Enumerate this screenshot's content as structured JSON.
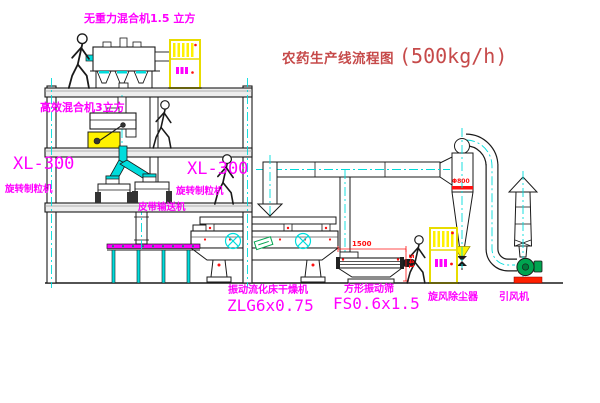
{
  "title": {
    "name": "农药生产线流程图",
    "capacity": "(500kg/h)"
  },
  "equipment_labels": {
    "gravity_mixer": "无重力混合机1.5 立方",
    "high_mixer": "高效混合机3立方",
    "granulator_left_model": "XL-300",
    "granulator_left_name": "旋转制粒机",
    "granulator_right_model": "XL-300",
    "granulator_right_name": "旋转制粒机",
    "belt_conveyor": "皮带输送机",
    "dryer_name": "振动流化床干燥机",
    "dryer_model": "ZLG6x0.75",
    "screen_name": "方形振动筛",
    "screen_model": "FS0.6x1.5",
    "cyclone": "旋风除尘器",
    "fan": "引风机"
  },
  "dimensions": {
    "screen_length": "1500",
    "screen_side": "541",
    "cyclone_dia": "Φ800"
  },
  "colors": {
    "label": "#FF00FF",
    "title": "#C64A4A",
    "centerline": "#00DCDC",
    "cabinet_yellow": "#FFF200",
    "accent_red": "#FF1010",
    "accent_green": "#00A550"
  }
}
